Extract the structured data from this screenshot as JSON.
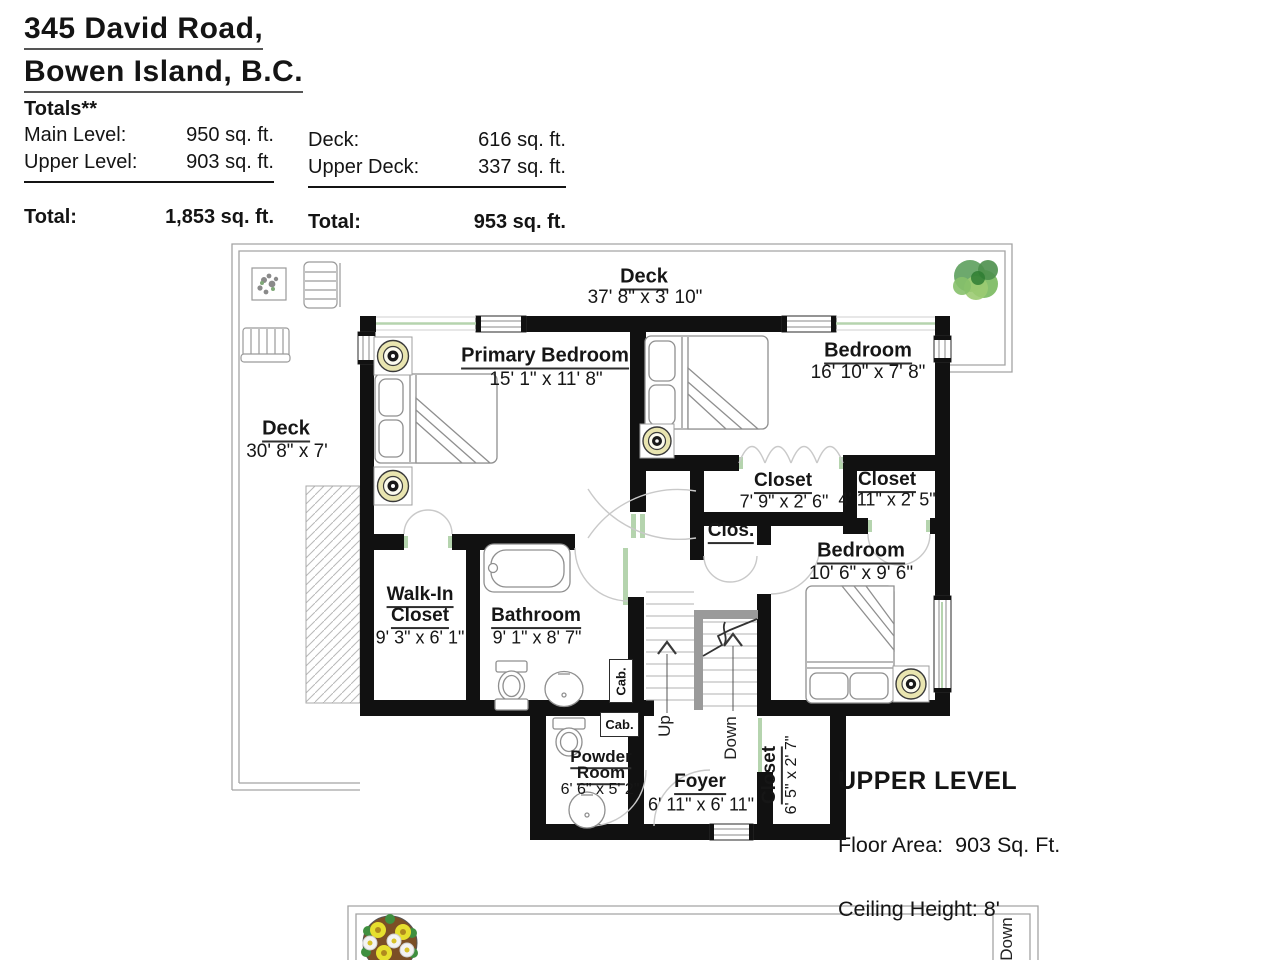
{
  "header": {
    "address_line1": "345 David Road,",
    "address_line2": "Bowen Island, B.C.",
    "totals_heading": "Totals**",
    "main_level_label": "Main Level:",
    "main_level_value": "950 sq. ft.",
    "upper_level_label": "Upper Level:",
    "upper_level_value": "903 sq. ft.",
    "left_total_label": "Total:",
    "left_total_value": "1,853 sq. ft.",
    "deck_label": "Deck:",
    "deck_value": "616 sq. ft.",
    "upper_deck_label": "Upper Deck:",
    "upper_deck_value": "337 sq. ft.",
    "right_total_label": "Total:",
    "right_total_value": "953 sq. ft."
  },
  "plan": {
    "deck_top": {
      "name": "Deck",
      "dims": "37' 8\" x 3' 10\""
    },
    "deck_left": {
      "name": "Deck",
      "dims": "30' 8\" x 7'"
    },
    "primary_bedroom": {
      "name": "Primary Bedroom",
      "dims": "15' 1\" x 11' 8\""
    },
    "bedroom_top": {
      "name": "Bedroom",
      "dims": "16' 10\" x 7' 8\""
    },
    "closet_1": {
      "name": "Closet",
      "dims": "7' 9\" x 2' 6\""
    },
    "closet_2": {
      "name": "Closet",
      "dims": "4' 11\" x 2' 5\""
    },
    "clos_small": {
      "name": "Clos."
    },
    "bedroom_right": {
      "name": "Bedroom",
      "dims": "10' 6\" x 9' 6\""
    },
    "walk_in_closet": {
      "name_line1": "Walk-In",
      "name_line2": "Closet",
      "dims": "9' 3\" x 6' 1\""
    },
    "bathroom": {
      "name": "Bathroom",
      "dims": "9' 1\" x 8' 7\""
    },
    "powder_room": {
      "name_line1": "Powder",
      "name_line2": "Room",
      "dims": "6' 6\" x 5' 2\""
    },
    "foyer": {
      "name": "Foyer",
      "dims": "6' 11\" x 6' 11\""
    },
    "closet_foyer": {
      "name": "Closet",
      "dims": "6' 5\" x 2' 7\""
    },
    "stairs": {
      "up": "Up",
      "down": "Down"
    },
    "cabinet_label_1": "Cab.",
    "cabinet_label_2": "Cab.",
    "bottom_deck_down": "Down",
    "level_title": "UPPER LEVEL",
    "floor_area_line": "Floor Area:  903 Sq. Ft.",
    "ceiling_line": "Ceiling Height: 8'"
  },
  "colors": {
    "wall": "#111111",
    "door_green": "#b5d4ae",
    "light_fill": "#e9e5b0",
    "stair_gray": "#9a9a9a",
    "deck_outline": "#a3a3a3"
  }
}
